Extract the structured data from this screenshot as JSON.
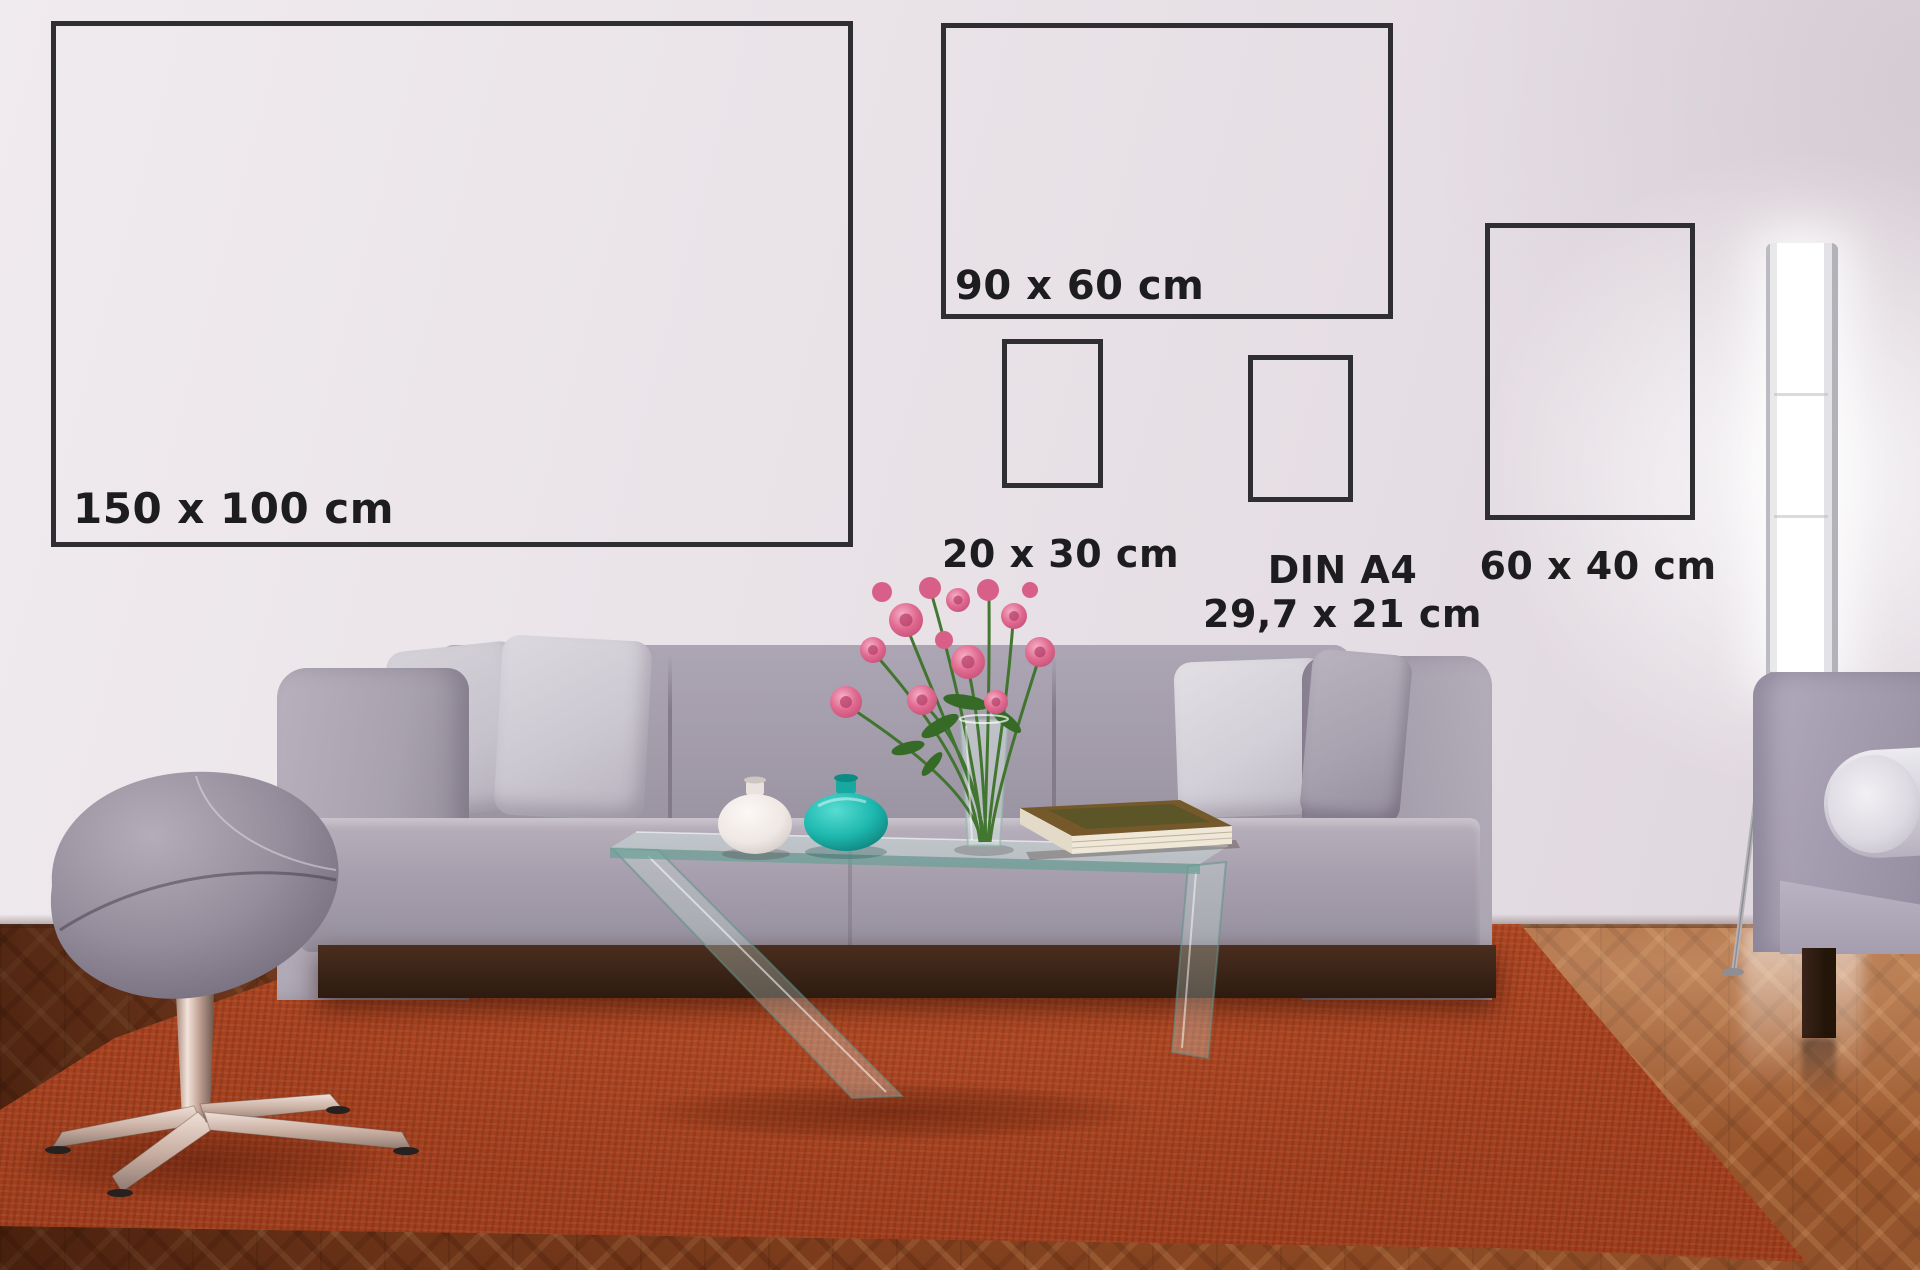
{
  "frames": [
    {
      "id": "150x100",
      "label": "150 x 100 cm",
      "x": 51,
      "y": 21,
      "w": 802,
      "h": 526,
      "label_placement": "inside-bottom-left",
      "label_dx": 22,
      "label_dy": -62,
      "font_px": 42
    },
    {
      "id": "90x60",
      "label": "90 x 60 cm",
      "x": 941,
      "y": 23,
      "w": 452,
      "h": 296,
      "label_placement": "inside-bottom-left",
      "label_dx": 14,
      "label_dy": -56,
      "font_px": 40
    },
    {
      "id": "20x30",
      "label": "20 x 30 cm",
      "x": 1002,
      "y": 339,
      "w": 101,
      "h": 149,
      "label_placement": "below-center",
      "label_dx": 8,
      "label_dy": 44,
      "font_px": 38
    },
    {
      "id": "din-a4",
      "label": "DIN A4",
      "label2": "29,7 x 21 cm",
      "x": 1248,
      "y": 355,
      "w": 105,
      "h": 147,
      "label_placement": "below-center",
      "label_dx": 42,
      "label_dy": 46,
      "font_px": 38
    },
    {
      "id": "60x40",
      "label": "60 x 40 cm",
      "x": 1485,
      "y": 223,
      "w": 210,
      "h": 297,
      "label_placement": "below-center",
      "label_dx": 8,
      "label_dy": 24,
      "font_px": 38
    }
  ],
  "frame_style": {
    "border_color": "#2e2e33",
    "border_px": 5,
    "label_color": "#1d1d1f"
  },
  "palette": {
    "wall": "#e9e3e8",
    "floor_wood": "#8f4a22",
    "rug_orange": "#bb4c25",
    "sofa_gray": "#a29aaa",
    "pillow_light": "#d6d3da",
    "ottoman_gray": "#8d8593",
    "teal_vase": "#1fb9b0",
    "white_vase": "#f3eeea",
    "flower_pink": "#e06a92",
    "stem_green": "#3c7329",
    "book_cover": "#75592b",
    "lamp_glow": "#ffffff",
    "plinth_wood": "#35200f"
  }
}
